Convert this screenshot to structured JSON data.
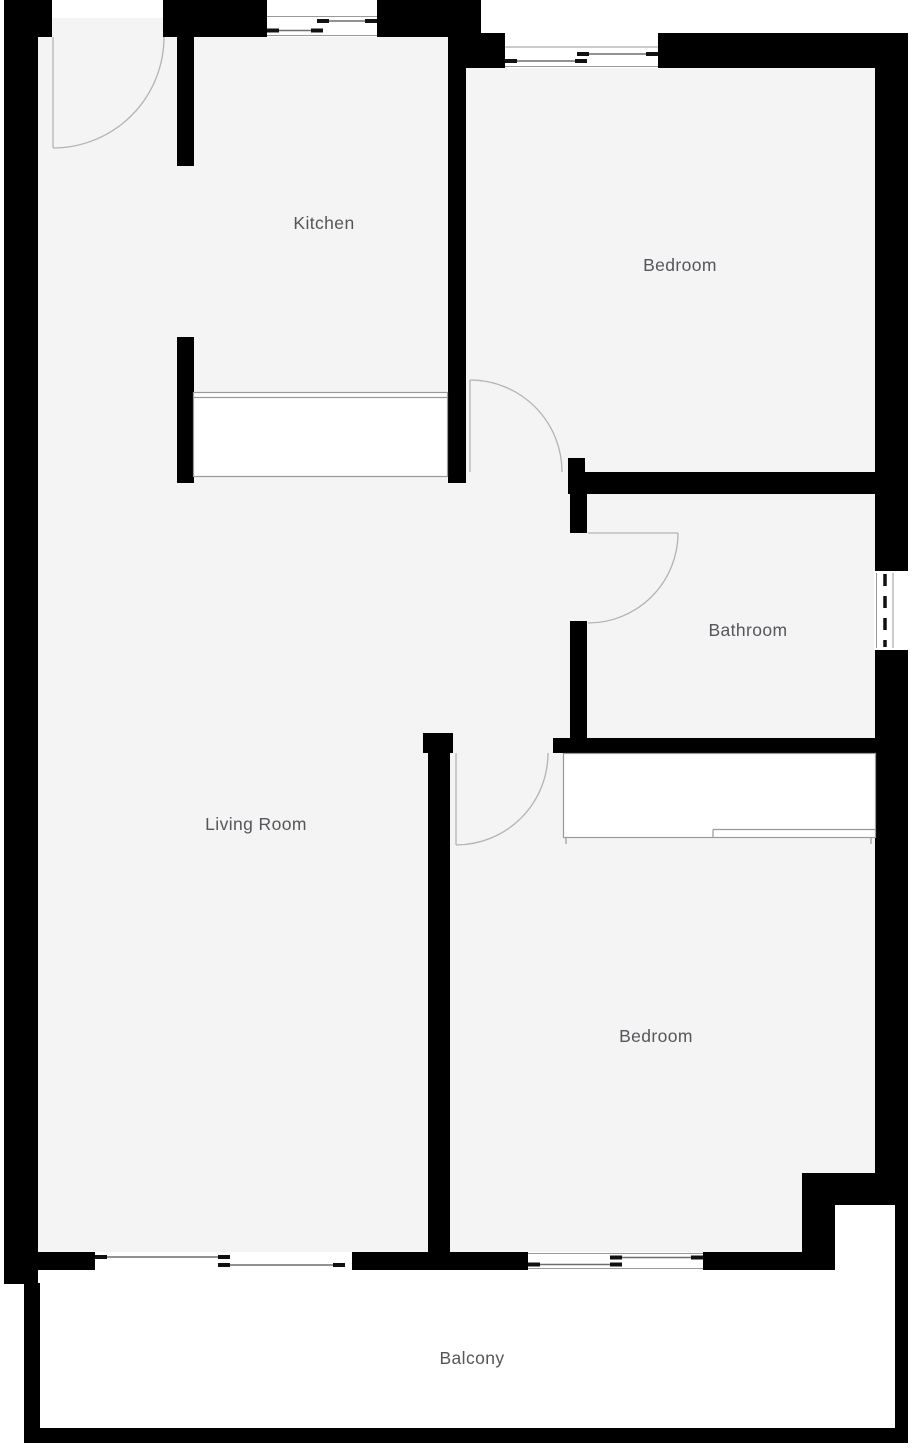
{
  "colors": {
    "wall": "#000000",
    "floor": "#f4f4f5",
    "exterior": "#ffffff",
    "door_line": "#b3b3b3",
    "fixture_line": "#9a9a9a",
    "window_line": "#9a9a9a",
    "window_tick": "#111111",
    "label": "#55565a"
  },
  "rooms": {
    "kitchen": {
      "label": "Kitchen"
    },
    "bedroom_top": {
      "label": "Bedroom"
    },
    "bathroom": {
      "label": "Bathroom"
    },
    "living_room": {
      "label": "Living Room"
    },
    "bedroom_bottom": {
      "label": "Bedroom"
    },
    "balcony": {
      "label": "Balcony"
    }
  }
}
